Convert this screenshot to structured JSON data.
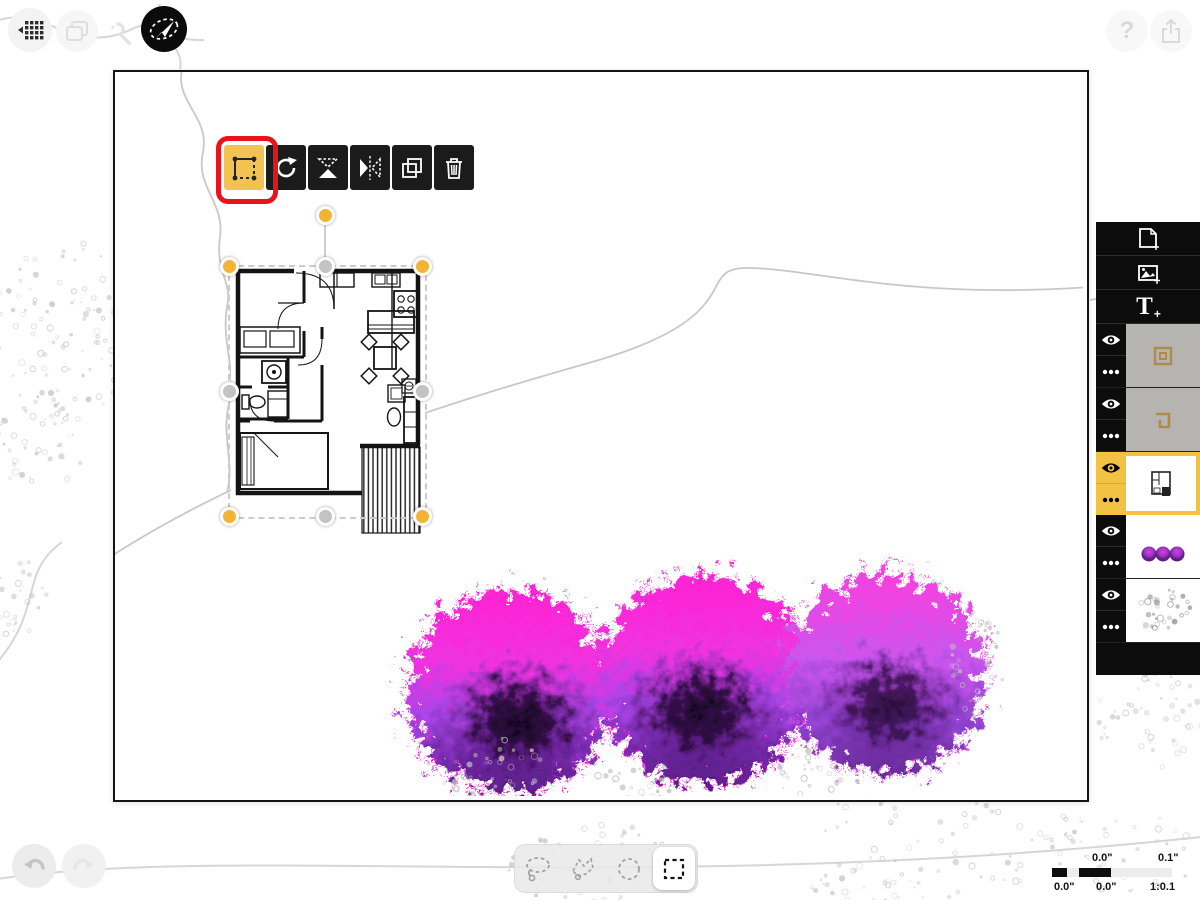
{
  "colors": {
    "accent_yellow": "#F2C243",
    "annotation_red": "#E9131B",
    "panel_black": "#0c0c0c",
    "handle_yellow": "#F2B434",
    "handle_gray": "#C3C3C3",
    "tree_pink": "#FF22D2",
    "tree_purple": "#8F42CF",
    "tree_dark": "#2A0836"
  },
  "top_left_toolbar": {
    "buttons": [
      {
        "name": "grid-menu",
        "icon": "grid-menu-icon"
      },
      {
        "name": "pages",
        "icon": "pages-icon"
      },
      {
        "name": "tools",
        "icon": "wrench-icon"
      },
      {
        "name": "select-mode",
        "icon": "selection-cursor-icon",
        "active": true
      }
    ]
  },
  "top_right_toolbar": {
    "help_glyph": "?",
    "buttons": [
      {
        "name": "help",
        "icon": "help-icon"
      },
      {
        "name": "share",
        "icon": "share-icon"
      }
    ]
  },
  "selection_toolbar": {
    "buttons": [
      {
        "name": "transform",
        "icon": "transform-icon",
        "active": true,
        "annotated_red": true
      },
      {
        "name": "rotate",
        "icon": "rotate-icon"
      },
      {
        "name": "flip-vertical",
        "icon": "flip-vertical-icon"
      },
      {
        "name": "flip-horizontal",
        "icon": "flip-horizontal-icon"
      },
      {
        "name": "duplicate",
        "icon": "duplicate-icon"
      },
      {
        "name": "delete",
        "icon": "trash-icon"
      }
    ]
  },
  "layers_panel": {
    "add_text_glyph": "T",
    "add_text_plus": "+",
    "add_buttons": [
      "add-page",
      "add-image",
      "add-text"
    ],
    "layers": [
      {
        "name": "shape-layer-1",
        "thumb": "square-outline-glyph",
        "visible": true,
        "selected": false
      },
      {
        "name": "shape-layer-2",
        "thumb": "corner-shape-glyph",
        "visible": true,
        "selected": false
      },
      {
        "name": "floor-plan-layer",
        "thumb": "floor-plan-mini",
        "visible": true,
        "selected": true
      },
      {
        "name": "trees-layer",
        "thumb": "three-purple-trees",
        "visible": true,
        "selected": false
      },
      {
        "name": "sketch-layer",
        "thumb": "speckle-texture",
        "visible": true,
        "selected": false
      }
    ]
  },
  "selection_tools": {
    "tools": [
      {
        "name": "freehand-lasso",
        "active": false
      },
      {
        "name": "polygon-lasso",
        "active": false
      },
      {
        "name": "ellipse-select",
        "active": false
      },
      {
        "name": "rectangle-select",
        "active": true
      }
    ]
  },
  "history": {
    "buttons": [
      {
        "name": "undo",
        "icon": "undo-icon"
      },
      {
        "name": "redo",
        "icon": "redo-icon"
      }
    ]
  },
  "scale_bar": {
    "top_left_label": "0.0\"",
    "top_right_label": "0.1\"",
    "bottom_left_label": "0.0\"",
    "bottom_center_label": "0.0\"",
    "scale_ratio_label": "1:0.1"
  }
}
